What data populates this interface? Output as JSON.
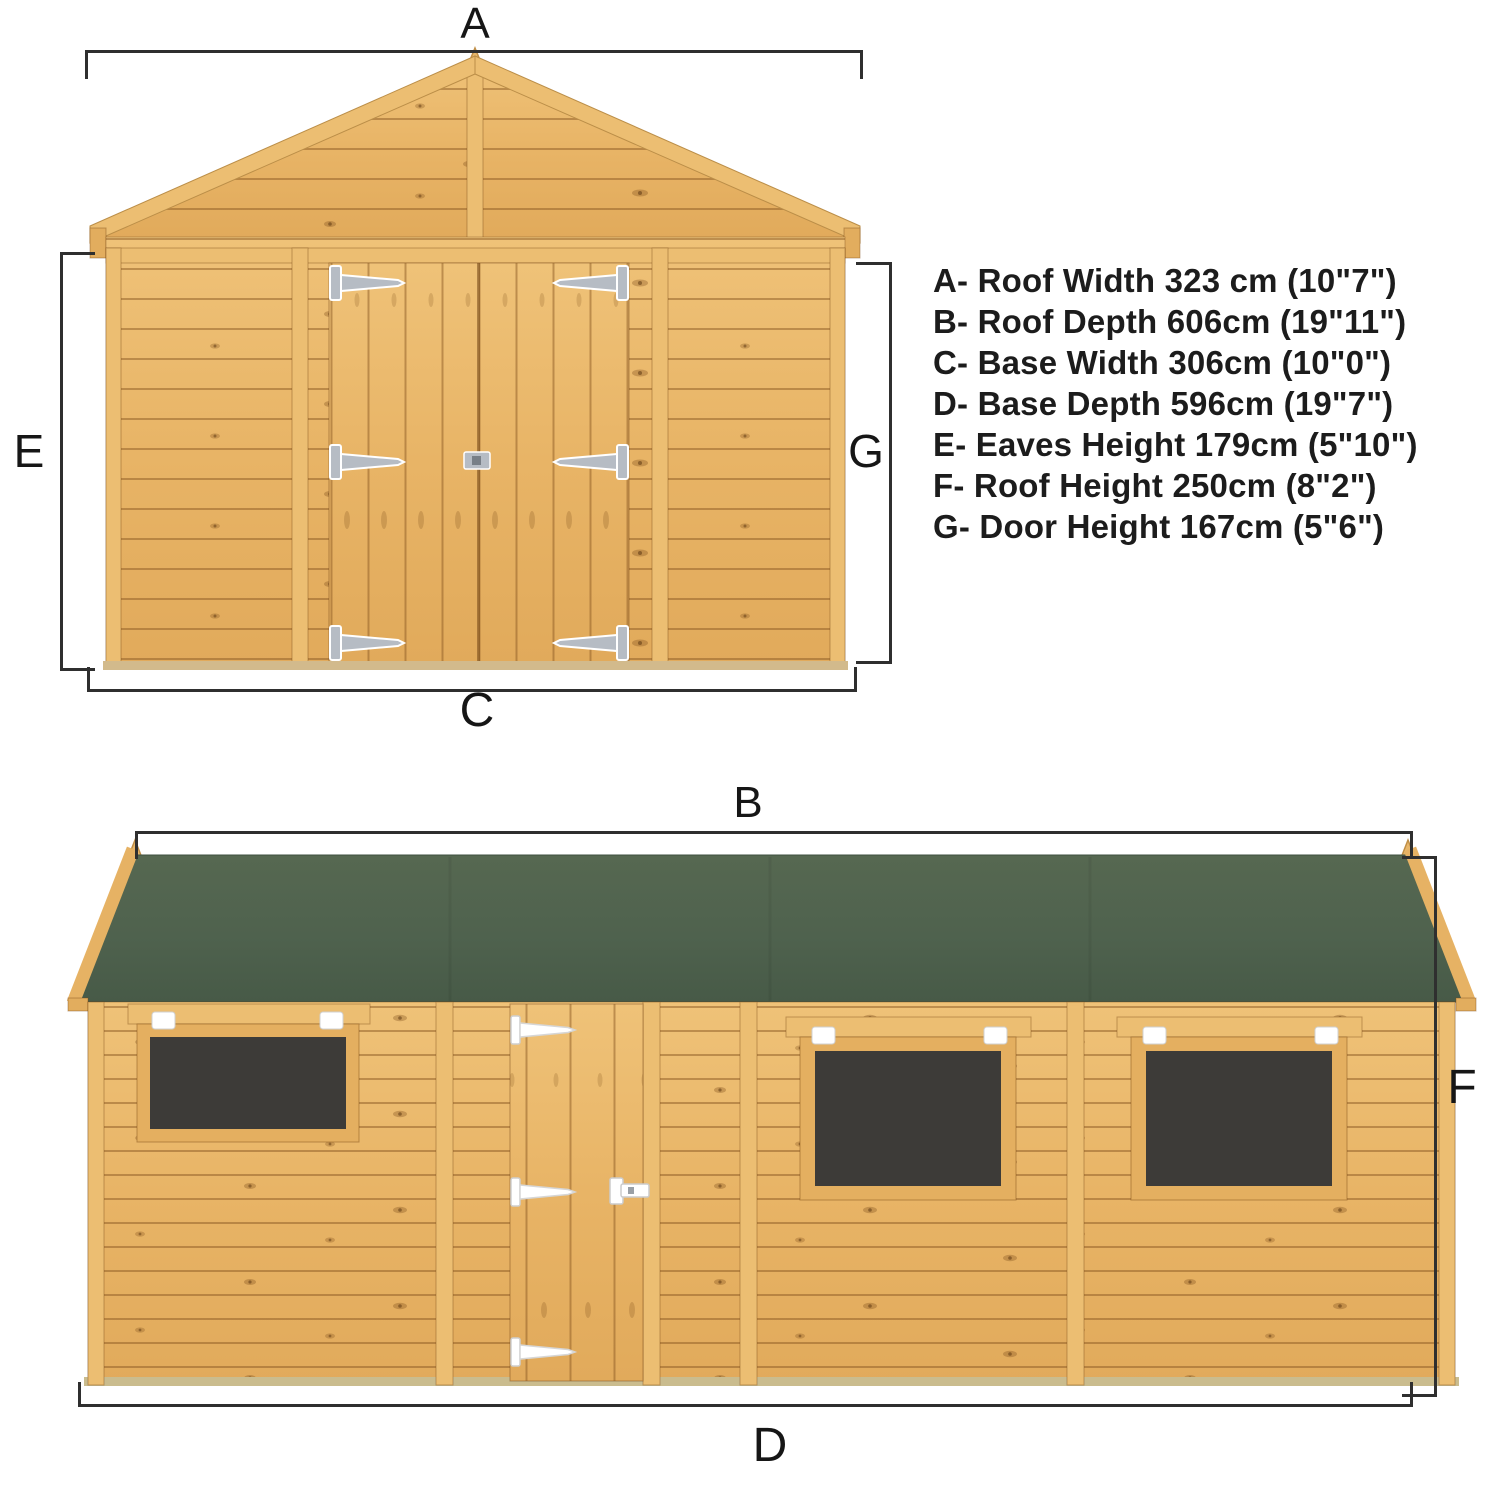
{
  "colors": {
    "wood": "#e7b466",
    "trim": "#ecbe72",
    "roof_felt_green": "#51644f",
    "window_glazing": "#3d3b38",
    "hinge_grey": "#b6bcc4",
    "hinge_white": "#ffffff",
    "dimension_line": "#2f2f2f",
    "text": "#1c1c1c"
  },
  "front_view": {
    "dim_labels": {
      "roof_width": "A",
      "base_width": "C",
      "eaves_height": "E",
      "door_height": "G"
    }
  },
  "side_view": {
    "dim_labels": {
      "roof_depth": "B",
      "base_depth": "D",
      "roof_height": "F"
    }
  },
  "legend": {
    "items": [
      {
        "key": "A",
        "text": "A- Roof Width 323 cm (10\"7\")"
      },
      {
        "key": "B",
        "text": "B- Roof Depth 606cm (19\"11\")"
      },
      {
        "key": "C",
        "text": "C- Base Width 306cm (10\"0\")"
      },
      {
        "key": "D",
        "text": "D- Base Depth 596cm (19\"7\")"
      },
      {
        "key": "E",
        "text": "E- Eaves Height 179cm (5\"10\")"
      },
      {
        "key": "F",
        "text": "F- Roof Height 250cm (8\"2\")"
      },
      {
        "key": "G",
        "text": "G- Door Height 167cm (5\"6\")"
      }
    ]
  }
}
